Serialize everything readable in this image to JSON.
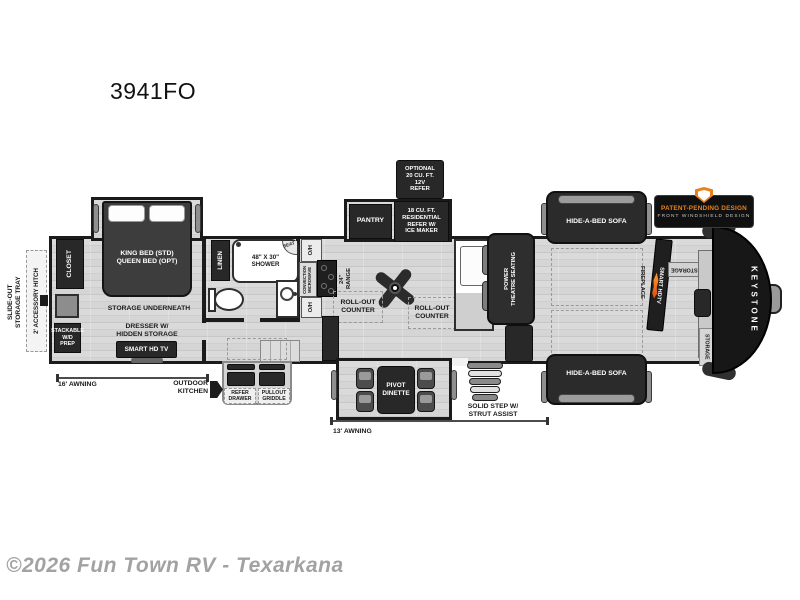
{
  "page": {
    "title": "3941FO",
    "watermark": "©2026 Fun Town RV - Texarkana"
  },
  "colors": {
    "accent_orange": "#E8821E",
    "flame_orange": "#FF7A1A",
    "wall": "#1B1B1B",
    "furniture_dark": "#282828",
    "floor_light": "#DEDEDE",
    "watermark_gray": "#9B9B9B"
  },
  "exterior": {
    "storage_tray": "SLIDE-OUT\nSTORAGE TRAY",
    "hitch": "2' ACCESSORY HITCH",
    "awning_left": "16'  AWNING",
    "awning_main": "13'  AWNING",
    "outdoor_kitchen": "OUTDOOR\nKITCHEN",
    "refer_drawer": "REFER\nDRAWER",
    "pullout_griddle": "PULLOUT\nGRIDDLE",
    "step": "SOLID STEP W/\nSTRUT ASSIST",
    "badge_line1": "PATENT-PENDING DESIGN",
    "badge_line2": "FRONT WINDSHIELD DESIGN",
    "brand": "KEYSTONE"
  },
  "bedroom": {
    "bed": "KING BED (STD)\nQUEEN BED (OPT)",
    "storage_underneath": "STORAGE UNDERNEATH",
    "dresser": "DRESSER W/\nHIDDEN STORAGE",
    "tv": "SMART HD TV",
    "closet": "CLOSET",
    "washer": "STACKABLE\nW/D\nPREP"
  },
  "bathroom": {
    "linen": "LINEN",
    "shower": "48\" X 30\"\nSHOWER",
    "seat": "SEAT",
    "oh_top": "O/H",
    "oh_bottom": "O/H",
    "microwave": "CONVECTION\nMICROWAVE"
  },
  "kitchen": {
    "range": "24\"\nRANGE",
    "pantry": "PANTRY",
    "refer": "18 CU. FT.\nRESIDENTIAL\nREFER W/\nICE MAKER",
    "optional_refer": "OPTIONAL\n20 CU. FT.\n12V\nREFER",
    "counter_left": "ROLL-OUT\nCOUNTER",
    "counter_right": "ROLL-OUT\nCOUNTER",
    "dinette": "PIVOT\nDINETTE"
  },
  "living": {
    "theatre": "POWER\nTHEATRE SEATING",
    "sofa_top": "HIDE-A-BED SOFA",
    "sofa_bottom": "HIDE-A-BED SOFA",
    "fireplace": "FIREPLACE",
    "tv": "SMART HDTV",
    "storage_shelf": "STORAGE",
    "desk": "DESK",
    "storage_front": "STORAGE"
  }
}
